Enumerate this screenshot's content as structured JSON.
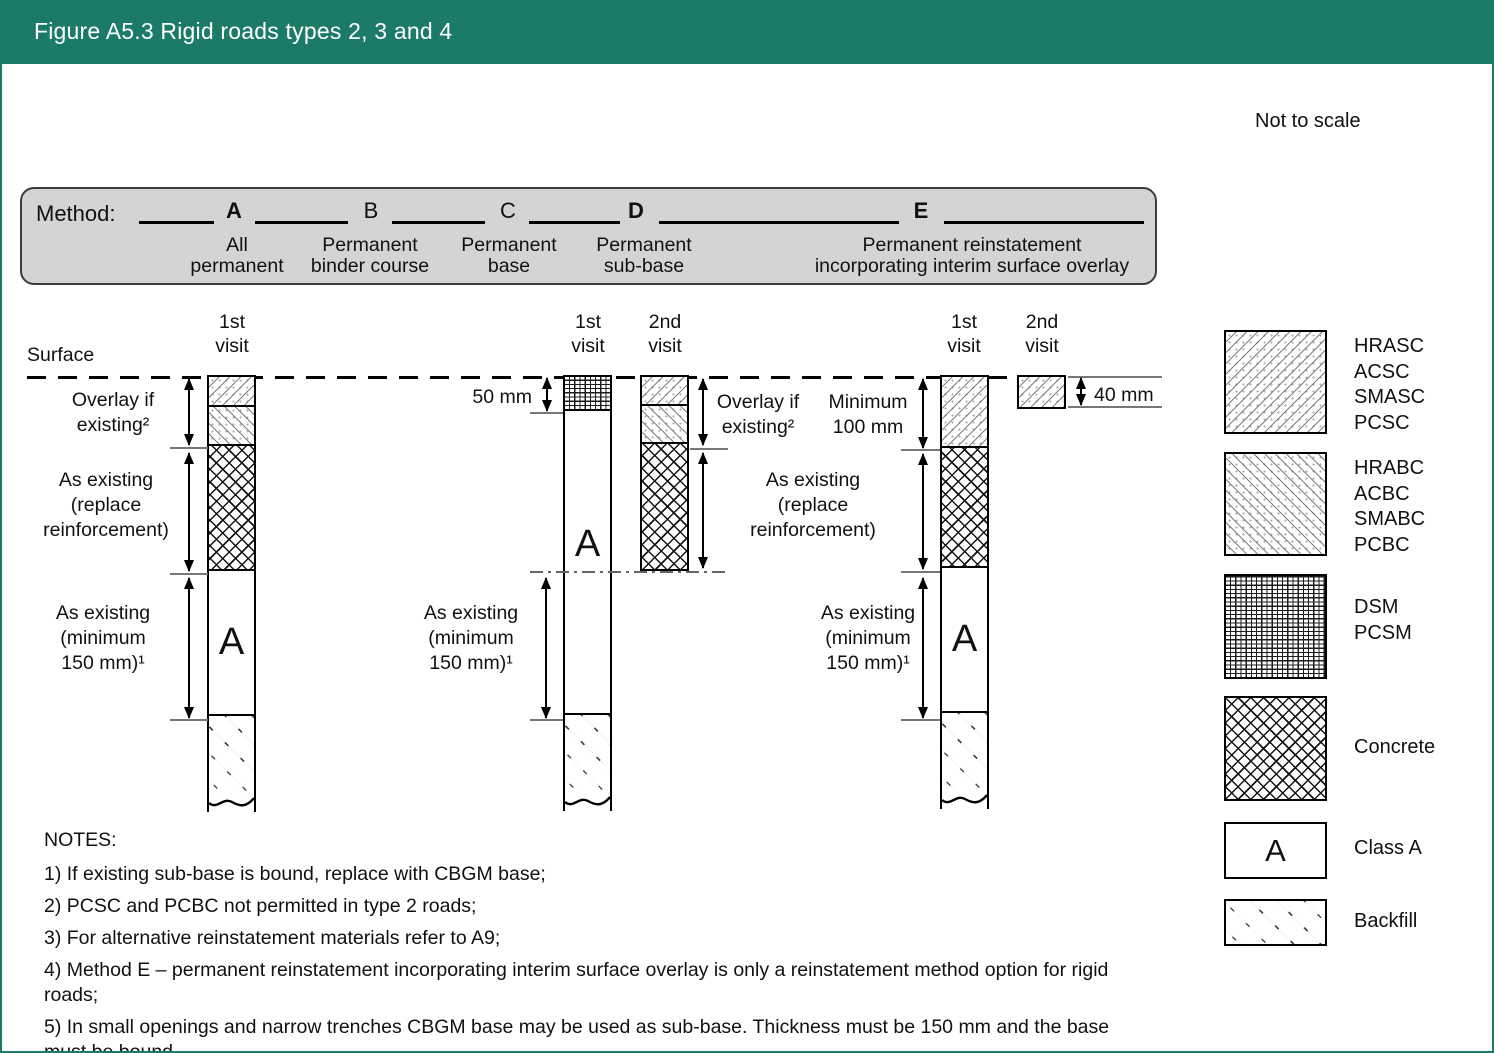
{
  "header": {
    "title": "Figure A5.3 Rigid roads types 2, 3 and 4"
  },
  "scale_note": "Not to scale",
  "method_bar": {
    "label": "Method:",
    "methods": [
      {
        "letter": "A",
        "lines": [
          "All",
          "permanent"
        ]
      },
      {
        "letter": "B",
        "lines": [
          "Permanent",
          "binder course"
        ]
      },
      {
        "letter": "C",
        "lines": [
          "Permanent",
          "base"
        ]
      },
      {
        "letter": "D",
        "lines": [
          "Permanent",
          "sub-base"
        ]
      },
      {
        "letter": "E",
        "lines": [
          "Permanent reinstatement",
          "incorporating interim surface overlay"
        ]
      }
    ]
  },
  "diagram": {
    "surface_label": "Surface",
    "class_a_letter": "A",
    "visit_headers": {
      "a1": [
        "1st",
        "visit"
      ],
      "b1": [
        "1st",
        "visit"
      ],
      "d2": [
        "2nd",
        "visit"
      ],
      "e1": [
        "1st",
        "visit"
      ],
      "e2": [
        "2nd",
        "visit"
      ]
    },
    "labels": {
      "overlay_if_existing": [
        "Overlay if",
        "existing²"
      ],
      "as_existing_replace": [
        "As existing",
        "(replace",
        "reinforcement)"
      ],
      "as_existing_min150": [
        "As existing",
        "(minimum",
        "150 mm)¹"
      ],
      "minimum_100": [
        "Minimum",
        "100 mm"
      ],
      "dim_50": "50 mm",
      "dim_40": "40 mm"
    }
  },
  "legend": {
    "items": [
      {
        "pattern": "hrasc",
        "labels": [
          "HRASC",
          "ACSC",
          "SMASC",
          "PCSC"
        ]
      },
      {
        "pattern": "hrabc",
        "labels": [
          "HRABC",
          "ACBC",
          "SMABC",
          "PCBC"
        ]
      },
      {
        "pattern": "dsm",
        "labels": [
          "DSM",
          "PCSM"
        ]
      },
      {
        "pattern": "concrete",
        "labels": [
          "Concrete"
        ]
      },
      {
        "pattern": "class-a",
        "letter": "A",
        "labels": [
          "Class A"
        ]
      },
      {
        "pattern": "backfill",
        "labels": [
          "Backfill"
        ]
      }
    ]
  },
  "notes": {
    "heading": "NOTES:",
    "items": [
      "1) If existing sub-base is bound, replace with CBGM base;",
      "2) PCSC and PCBC not permitted in type 2 roads;",
      "3) For alternative reinstatement materials refer to A9;",
      "4) Method E – permanent reinstatement incorporating interim surface overlay is only a reinstatement method option for rigid roads;",
      "5) In small openings and narrow trenches CBGM base may be used as sub-base. Thickness must be 150 mm and the base must be bound."
    ]
  },
  "colors": {
    "teal": "#1b7b68",
    "bar_gray": "#d4d4d4"
  }
}
